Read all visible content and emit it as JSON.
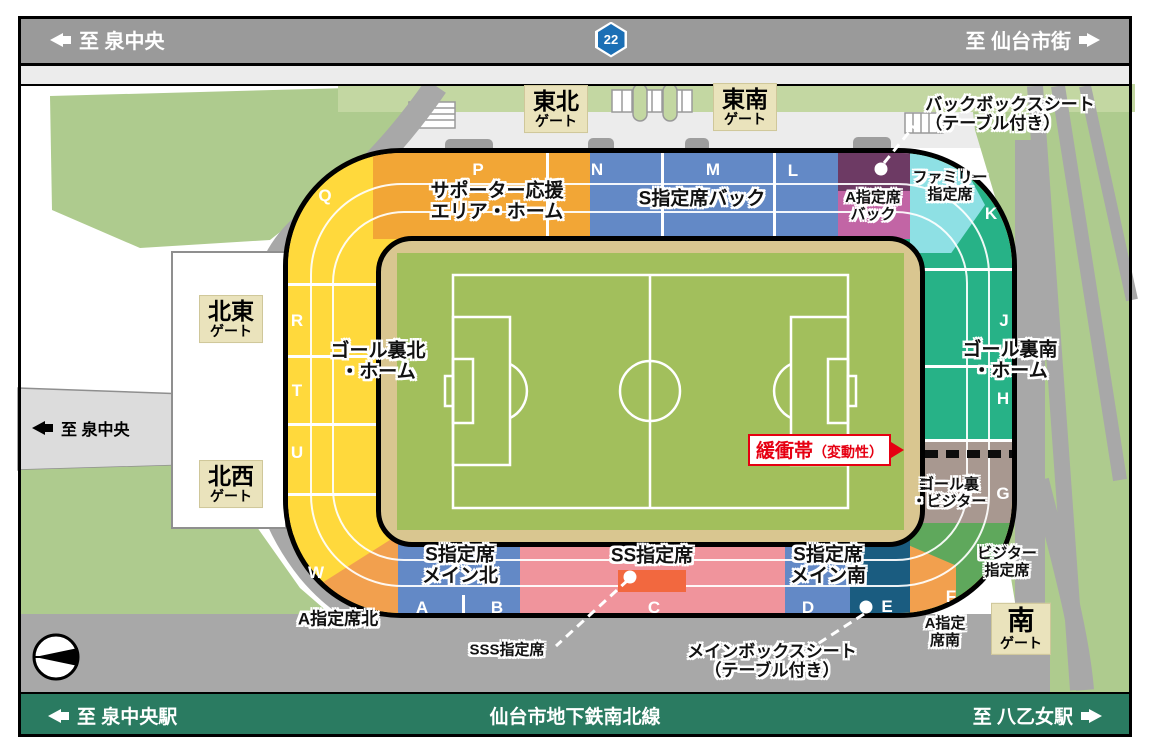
{
  "top_road": {
    "left_label": "至 泉中央",
    "route_number": "22",
    "right_label": "至 仙台市街"
  },
  "mid_road": {
    "label": "至 泉中央"
  },
  "bottom_rail": {
    "left_label": "至 泉中央駅",
    "center_label": "仙台市地下鉄南北線",
    "right_label": "至 八乙女駅"
  },
  "gates": {
    "east_north": {
      "line1": "東北",
      "line2": "ゲート"
    },
    "east_south": {
      "line1": "東南",
      "line2": "ゲート"
    },
    "north_east": {
      "line1": "北東",
      "line2": "ゲート"
    },
    "north_west": {
      "line1": "北西",
      "line2": "ゲート"
    },
    "south": {
      "line1": "南",
      "line2": "ゲート"
    }
  },
  "sections": {
    "supporter_area": {
      "line1": "サポーター応援",
      "line2": "エリア・ホーム"
    },
    "s_reserved_back": {
      "label": "S指定席バック"
    },
    "a_reserved_back": {
      "line1": "A指定席",
      "line2": "バック"
    },
    "family_reserved": {
      "line1": "ファミリー",
      "line2": "指定席"
    },
    "goal_back_north_home": {
      "line1": "ゴール裏北",
      "line2": "・ホーム"
    },
    "goal_back_south_home": {
      "line1": "ゴール裏南",
      "line2": "・ホーム"
    },
    "goal_back_visitor": {
      "line1": "ゴール裏",
      "line2": "・ビジター"
    },
    "visitor_reserved": {
      "line1": "ビジター",
      "line2": "指定席"
    },
    "s_reserved_main_north": {
      "line1": "S指定席",
      "line2": "メイン北"
    },
    "ss_reserved": {
      "label": "SS指定席"
    },
    "s_reserved_main_south": {
      "line1": "S指定席",
      "line2": "メイン南"
    },
    "a_reserved_south": {
      "line1": "A指定",
      "line2": "席南"
    },
    "a_reserved_north": {
      "label": "A指定席北"
    }
  },
  "block_letters": {
    "P": "P",
    "N": "N",
    "M": "M",
    "L": "L",
    "Q": "Q",
    "R": "R",
    "T": "T",
    "U": "U",
    "W": "W",
    "K": "K",
    "J": "J",
    "H": "H",
    "G": "G",
    "F": "F",
    "A": "A",
    "B": "B",
    "C": "C",
    "D": "D",
    "E": "E"
  },
  "annotations": {
    "back_box_seat": {
      "line1": "バックボックスシート",
      "line2": "（テーブル付き）"
    },
    "buffer_zone": {
      "main": "緩衝帯",
      "sub": "（変動性）"
    },
    "sss_reserved": {
      "label": "SSS指定席"
    },
    "main_box_seat": {
      "line1": "メインボックスシート",
      "line2": "（テーブル付き）"
    }
  },
  "colors": {
    "yellow": "#FFD93C",
    "orange": "#F2A636",
    "deep_orange": "#F2A04E",
    "blue": "#6389C6",
    "navy": "#1A5C80",
    "pink": "#F0949C",
    "sss_red": "#F2683F",
    "purple": "#6D3A64",
    "magenta": "#C265A5",
    "cyan": "#8EE0E4",
    "teal": "#27B287",
    "visitor_green": "#5FA85C",
    "taupe": "#A89890",
    "track_tan": "#D9C690",
    "pitch_green": "#A2BF5C",
    "road_grey": "#9A9A9A",
    "rail_green": "#2A7B61",
    "gate_beige": "#EAE3BC",
    "buffer_red": "#E60012",
    "route_blue": "#1B6FB5"
  }
}
